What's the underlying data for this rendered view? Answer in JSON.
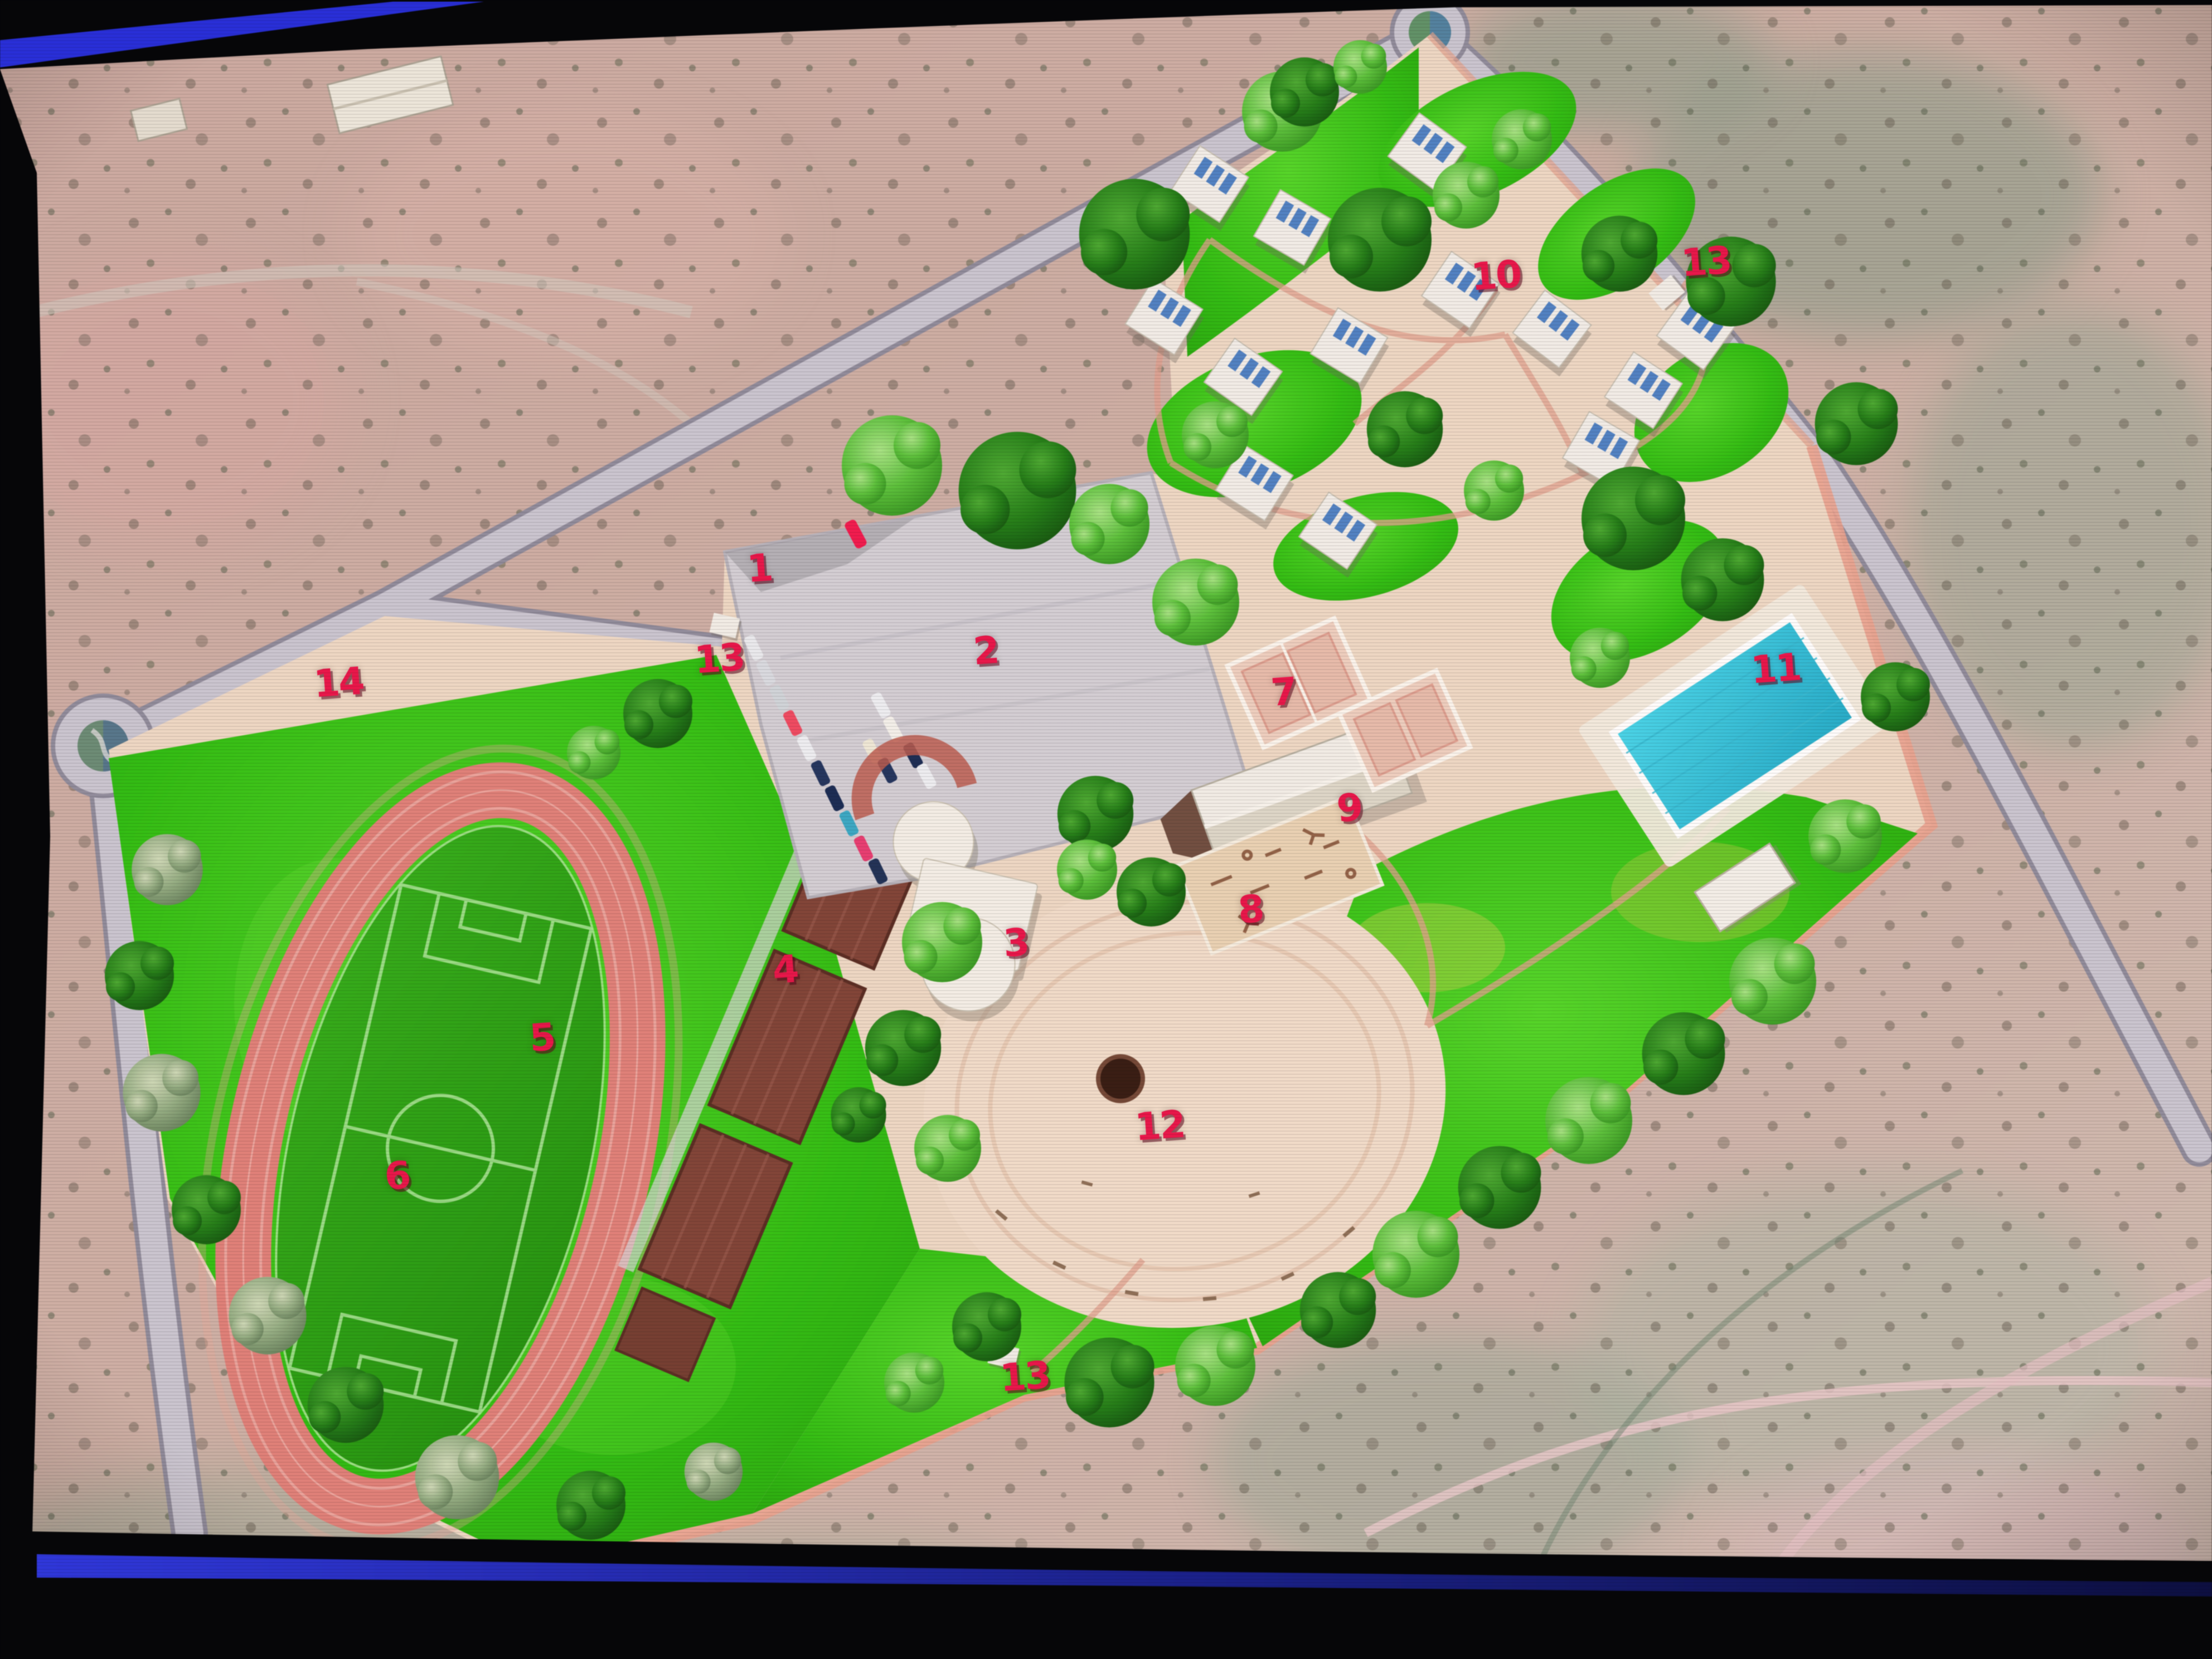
{
  "map_markers": [
    {
      "id": "marker-1",
      "label": "1"
    },
    {
      "id": "marker-2",
      "label": "2"
    },
    {
      "id": "marker-3",
      "label": "3"
    },
    {
      "id": "marker-4",
      "label": "4"
    },
    {
      "id": "marker-5",
      "label": "5"
    },
    {
      "id": "marker-6",
      "label": "6"
    },
    {
      "id": "marker-7",
      "label": "7"
    },
    {
      "id": "marker-8",
      "label": "8"
    },
    {
      "id": "marker-9",
      "label": "9"
    },
    {
      "id": "marker-10",
      "label": "10"
    },
    {
      "id": "marker-11",
      "label": "11"
    },
    {
      "id": "marker-12",
      "label": "12"
    },
    {
      "id": "marker-13-north",
      "label": "13"
    },
    {
      "id": "marker-13-west",
      "label": "13"
    },
    {
      "id": "marker-13-south",
      "label": "13"
    },
    {
      "id": "marker-14",
      "label": "14"
    }
  ],
  "colors": {
    "marker_red": "#e8174a",
    "bezel_blue": "#2c33db",
    "road_gray": "#c9c6d1",
    "park_ground": "#ecd8c6",
    "lawn_green": "#2fbb13",
    "track_pink": "#db7f78",
    "pool_cyan": "#3fc9df",
    "cabin_white": "#f2efe9",
    "grandstand_brown": "#7b4134",
    "desert_tan": "#c8a69e"
  }
}
